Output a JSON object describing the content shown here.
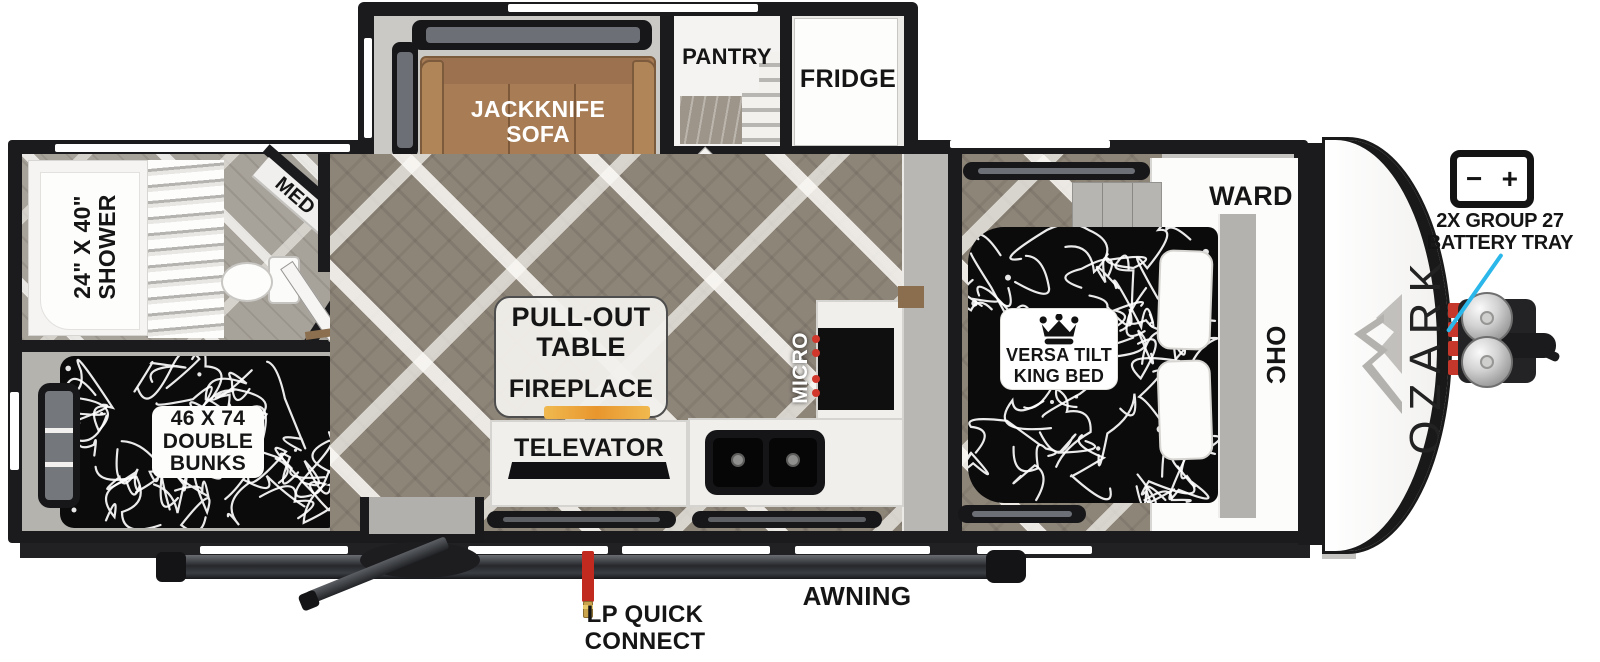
{
  "floorplan": {
    "brand": "OZARK",
    "labels": {
      "shower": {
        "line1": "24\" X 40\"",
        "line2": "SHOWER"
      },
      "med": "MED",
      "bunks": {
        "line1": "46 X 74",
        "line2": "DOUBLE",
        "line3": "BUNKS"
      },
      "sofa": {
        "line1": "JACKKNIFE",
        "line2": "SOFA"
      },
      "pantry": "PANTRY",
      "fridge": "FRIDGE",
      "table": {
        "line1": "PULL-OUT",
        "line2": "TABLE"
      },
      "fireplace": "FIREPLACE",
      "televator": "TELEVATOR",
      "micro": "MICRO",
      "king_bed": {
        "line1": "VERSA TILT",
        "line2": "KING BED"
      },
      "ward": "WARD",
      "ohc": "OHC",
      "awning": "AWNING",
      "lp": {
        "line1": "LP QUICK",
        "line2": "CONNECT"
      },
      "battery": {
        "line1": "2X GROUP 27",
        "line2": "BATTERY TRAY",
        "minus": "−",
        "plus": "+"
      }
    },
    "icons": {
      "crown": "crown-icon",
      "mountain": "mountain-icon",
      "battery": "battery-icon"
    },
    "colors": {
      "accent_cyan": "#2bb7ea",
      "battery_red": "#c4372a",
      "sofa_brown": "#a87d55",
      "fireplace_amber": "#f2a93b",
      "wall_black": "#1b1b1d"
    }
  }
}
